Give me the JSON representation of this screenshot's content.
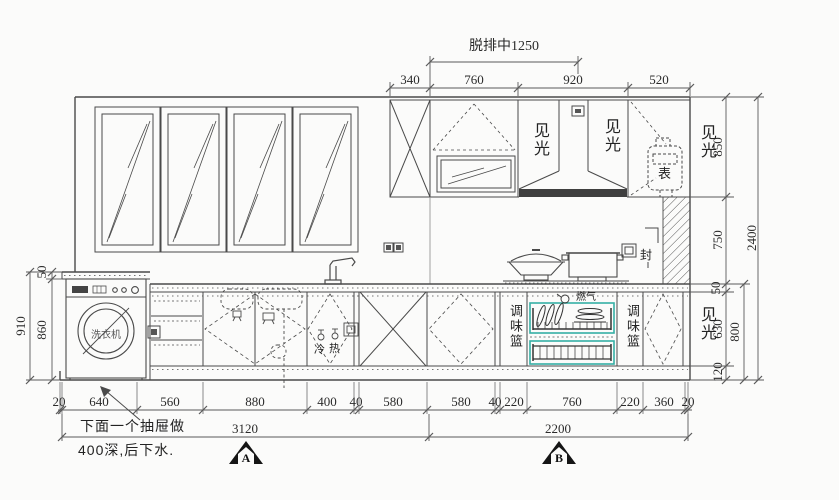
{
  "drawing": {
    "top_dims": {
      "hood_center_label": "脱排中1250",
      "segments": [
        "340",
        "760",
        "920",
        "520"
      ]
    },
    "right_dims": {
      "segments": [
        "850",
        "750",
        "50",
        "630",
        "120"
      ],
      "subtotal": "800",
      "total": "2400"
    },
    "left_dims": {
      "segments": [
        "50",
        "860"
      ],
      "total": "910"
    },
    "bottom_dims": {
      "segments": [
        "20",
        "640",
        "560",
        "880",
        "400",
        "40",
        "580",
        "580",
        "40",
        "220",
        "760",
        "220",
        "360",
        "20"
      ],
      "subtotals": [
        "3120",
        "2200"
      ]
    },
    "labels": {
      "exposed": "见光",
      "gas_meter": "表",
      "sealed": "封",
      "spice_basket": "调味篮",
      "gas": "燃气",
      "cold": "冷",
      "hot": "热",
      "washing_machine": "洗衣机"
    },
    "notes": {
      "line1": "下面一个抽屉做",
      "line2": "400深,后下水."
    },
    "sections": {
      "a": "A",
      "b": "B"
    },
    "colors": {
      "line": "#4a4a4a",
      "accent": "#35b0a5",
      "hood_band": "#3f3f3f"
    }
  }
}
